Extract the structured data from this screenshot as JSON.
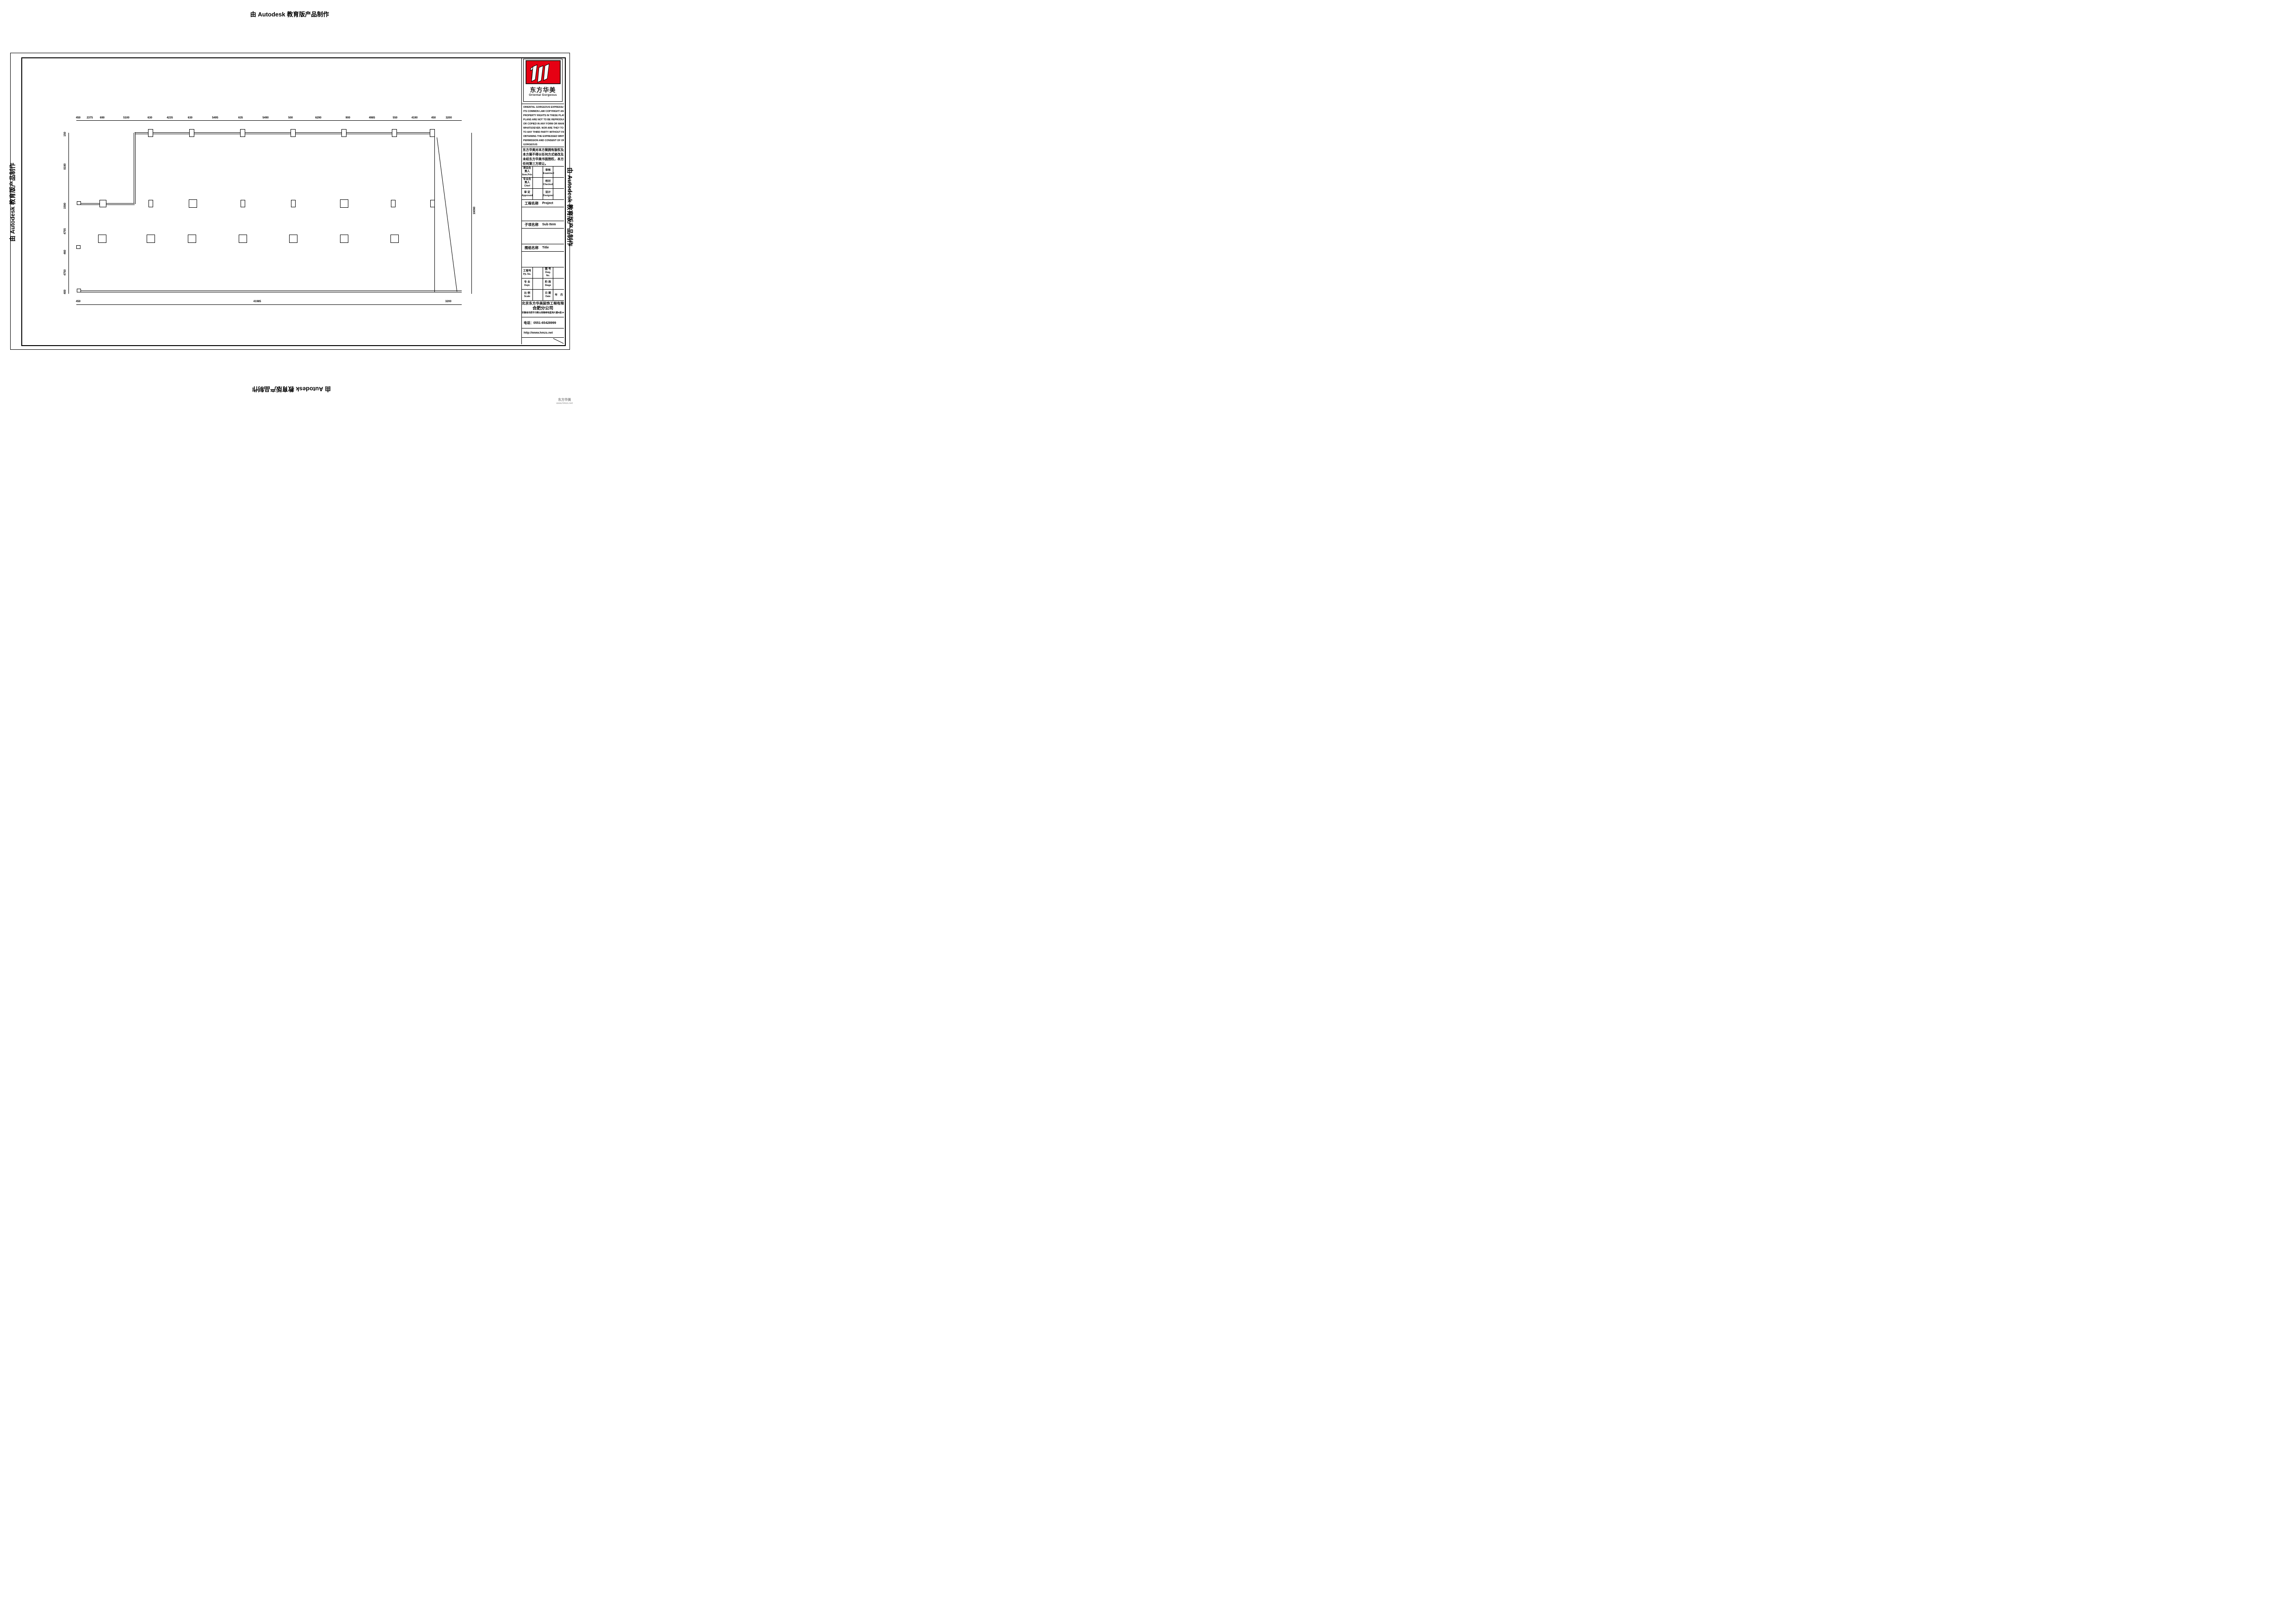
{
  "watermarks": {
    "autodesk": "由 Autodesk 教育版产品制作"
  },
  "corner_brand": {
    "name": "东方华美",
    "site": "www.hmzs.net"
  },
  "logo": {
    "cn": "东方华美",
    "en": "Oriental Gorgeous"
  },
  "copyright_en": [
    "ORIENTAL GORGEOUS EXPRESSLY RESERVES",
    "ITS COMMON LAW COPYRIGHT AND OTHER",
    "PROPERTY RIGHTS IN THESE PLANS. THESE",
    "PLANS ARE NOT TO BE REPRODUCED CHANGED",
    "OR COPIED IN ANY FORM OR MANNER",
    "WHATSOEVER. NOR ARE THEY TO BE ASSIGNED",
    "TO ANY THIRD PARTY WITHOUT FIRST",
    "OBTAINING THE EXPRESSED WRITTEN",
    "PERMISSION AND CONSENT OF ORIENTAL",
    "GORGEOUS"
  ],
  "copyright_cn": [
    "东方华美对本方案拥有版权及所有权。",
    "本方案不得以任何方式修改及复制。",
    "未经东方华美书面授权，本方案不得向",
    "任何第三方转让。"
  ],
  "personnel": {
    "r1c1cn": "项目负责人",
    "r1c1en": "Item.Prin",
    "r1c3cn": "审核",
    "r1c3en": "Examined",
    "r2c1cn": "专业负责人",
    "r2c1en": "Chief",
    "r2c3cn": "校对",
    "r2c3en": "Checked",
    "r3c1cn": "审 定",
    "r3c1en": "Approved",
    "r3c3cn": "设计",
    "r3c3en": "Designed"
  },
  "sections": {
    "project_cn": "工程名称",
    "project_en": "Project",
    "sub_cn": "子项名称",
    "sub_en": "Sub Item",
    "title_cn": "图纸名称",
    "title_en": "Title"
  },
  "fields": {
    "r1c1cn": "工程号",
    "r1c1en": "Pjt. No.",
    "r1c3cn": "图 号",
    "r1c3en": "Dwg. No.",
    "r2c1cn": "专 业",
    "r2c1en": "Dept.",
    "r2c3cn": "阶 段",
    "r2c3en": "Stage",
    "r3c1cn": "比 例",
    "r3c1en": "Scale",
    "r3c3cn": "日 期",
    "r3c3en": "Date",
    "r3c4": "年　月"
  },
  "company": {
    "name": "北京东方华美装饰工程有限公司",
    "branch": "合肥分公司",
    "address": "安徽省合肥市马鞍山南路绿地蓝海大厦B座19楼",
    "phone": "电话：0551-65428999",
    "website": "http://www.hmzs.net"
  },
  "plan": {
    "dims_top": [
      "450",
      "2375",
      "690",
      "5100",
      "630",
      "4235",
      "630",
      "5495",
      "635",
      "5490",
      "500",
      "6290",
      "900",
      "4985",
      "550",
      "4190",
      "450",
      "3200"
    ],
    "dims_left": [
      "150",
      "8190",
      "1590",
      "4755",
      "460",
      "4750",
      "400"
    ],
    "dims_bottom": [
      "450",
      "41985",
      "3200"
    ],
    "dim_right": "19090"
  },
  "colors": {
    "logo_red": "#e60013",
    "line": "#000000"
  }
}
